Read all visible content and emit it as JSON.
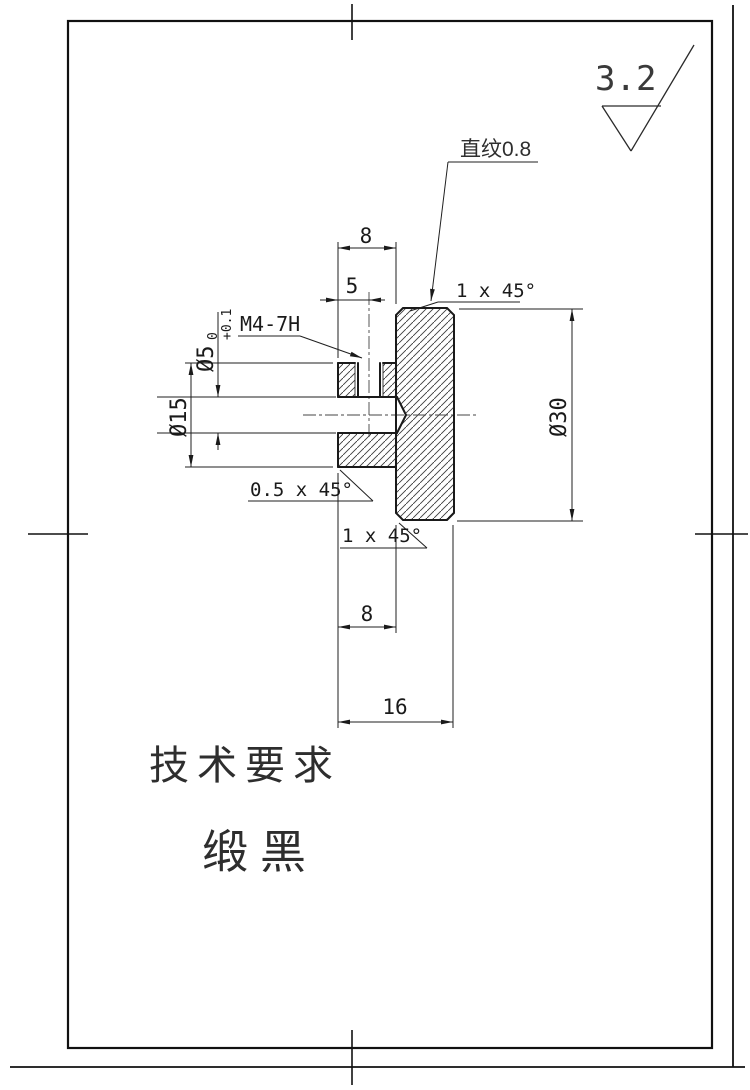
{
  "drawing": {
    "roughness": "3.2",
    "knurl_note": "直纹0.8",
    "chamfer_top": "1 x 45°",
    "chamfer_bottom": "1 x 45°",
    "chamfer_hub": "0.5 x 45°",
    "thread_label": "M4-7H",
    "bore": {
      "dia": "Ø5",
      "tol_upper": "+0.1",
      "tol_lower": "0"
    },
    "hub_dia": "Ø15",
    "head_dia": "Ø30",
    "dims": {
      "head_top_width": "8",
      "thread_offset": "5",
      "hub_width": "8",
      "total_width": "16"
    },
    "notes": {
      "heading": "技术要求",
      "line1": "缎黑"
    }
  }
}
